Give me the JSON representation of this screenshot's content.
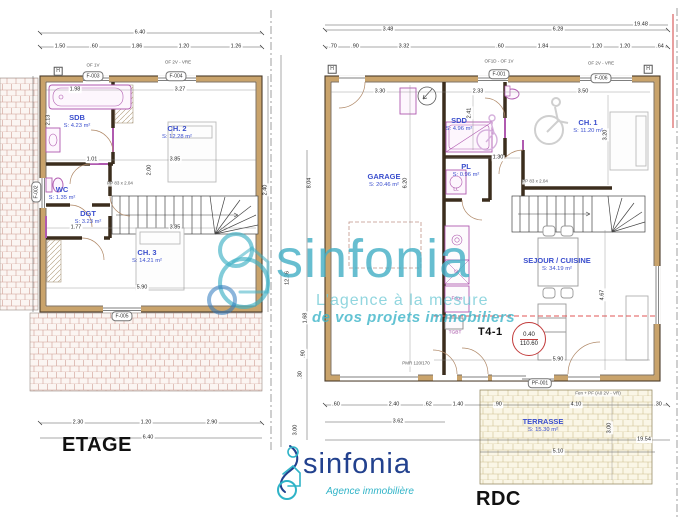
{
  "titles": {
    "left": "ETAGE",
    "right": "RDC"
  },
  "watermark": {
    "brand": "sinfonia",
    "tagline1": "L'agence à la mesure",
    "tagline2": "de vos projets immobiliers"
  },
  "logo": {
    "brand": "sinfonia",
    "subtitle": "Agence immobilière"
  },
  "badge": {
    "unit": "T4-1",
    "top": "0.40",
    "bottom": "110.60"
  },
  "h_marker": "H",
  "colors": {
    "teal": "#3fb0c4",
    "navy": "#22418e",
    "wall_tan": "#c9a36b",
    "room_blue": "#3a4ecd",
    "fixture_purple": "#b05ab0",
    "red_dash": "#e05555",
    "badge_red": "#c23b3b"
  },
  "etage": {
    "rooms": [
      {
        "name": "SDB",
        "area": "S: 4.23 m²"
      },
      {
        "name": "CH. 2",
        "area": "S: 12.28 m²"
      },
      {
        "name": "WC",
        "area": "S: 1.35 m²"
      },
      {
        "name": "DGT",
        "area": "S: 3.23 m²"
      },
      {
        "name": "CH. 3",
        "area": "S: 14.21 m²"
      }
    ],
    "tags": [
      "F-003",
      "F-004",
      "F-002",
      "F-005"
    ],
    "annotations": [
      "OF 1V",
      "OF 2V - VRE",
      "PP 83 x 2.04"
    ],
    "dims": [
      "6.40",
      "1.50",
      ".60",
      "1.86",
      "1.20",
      "1.26",
      "1.98",
      "3.27",
      "1.01",
      "3.85",
      "1.77",
      "3.85",
      "5.90",
      "2.30",
      "1.20",
      "2.90",
      "6.40",
      "2.13",
      "2.00",
      "2.40"
    ]
  },
  "rdc": {
    "rooms": [
      {
        "name": "GARAGE",
        "area": "S: 20.46 m²"
      },
      {
        "name": "SDD",
        "area": "S: 4.96 m²"
      },
      {
        "name": "PL",
        "area": "S: 0.96 m²"
      },
      {
        "name": "CH. 1",
        "area": "S: 11.20 m²"
      },
      {
        "name": "SEJOUR / CUISINE",
        "area": "S: 34.19 m²"
      },
      {
        "name": "TERRASSE",
        "area": "S: 15.30 m²"
      }
    ],
    "tags": [
      "F-001",
      "F-006",
      "PF-001"
    ],
    "annotations": [
      "OF1D - OF 1V",
      "OF 2V - VRE",
      "Fen + PF (A0 2V - VR)",
      "PMR 120/170",
      "PP 83 x 2.04"
    ],
    "labels": {
      "ll": "LL",
      "lv": "LV",
      "frigo": "Frigo",
      "tgbt": "TGBT"
    },
    "dims": [
      "3.48",
      "6.28",
      ".70",
      ".90",
      "3.32",
      ".60",
      "1.84",
      "1.20",
      "19.48",
      "1.20",
      ".64",
      "3.30",
      "2.33",
      "3.50",
      "1.30",
      "5.90",
      ".60",
      "2.40",
      ".62",
      "3.62",
      "1.40",
      ".90",
      "4.10",
      ".30",
      "5.10",
      "19.54",
      "6.20",
      "2.41",
      "3.20",
      "4.67",
      "3.00",
      "8.04",
      "12.36",
      "1.68",
      ".90",
      ".30",
      "3.00"
    ]
  }
}
